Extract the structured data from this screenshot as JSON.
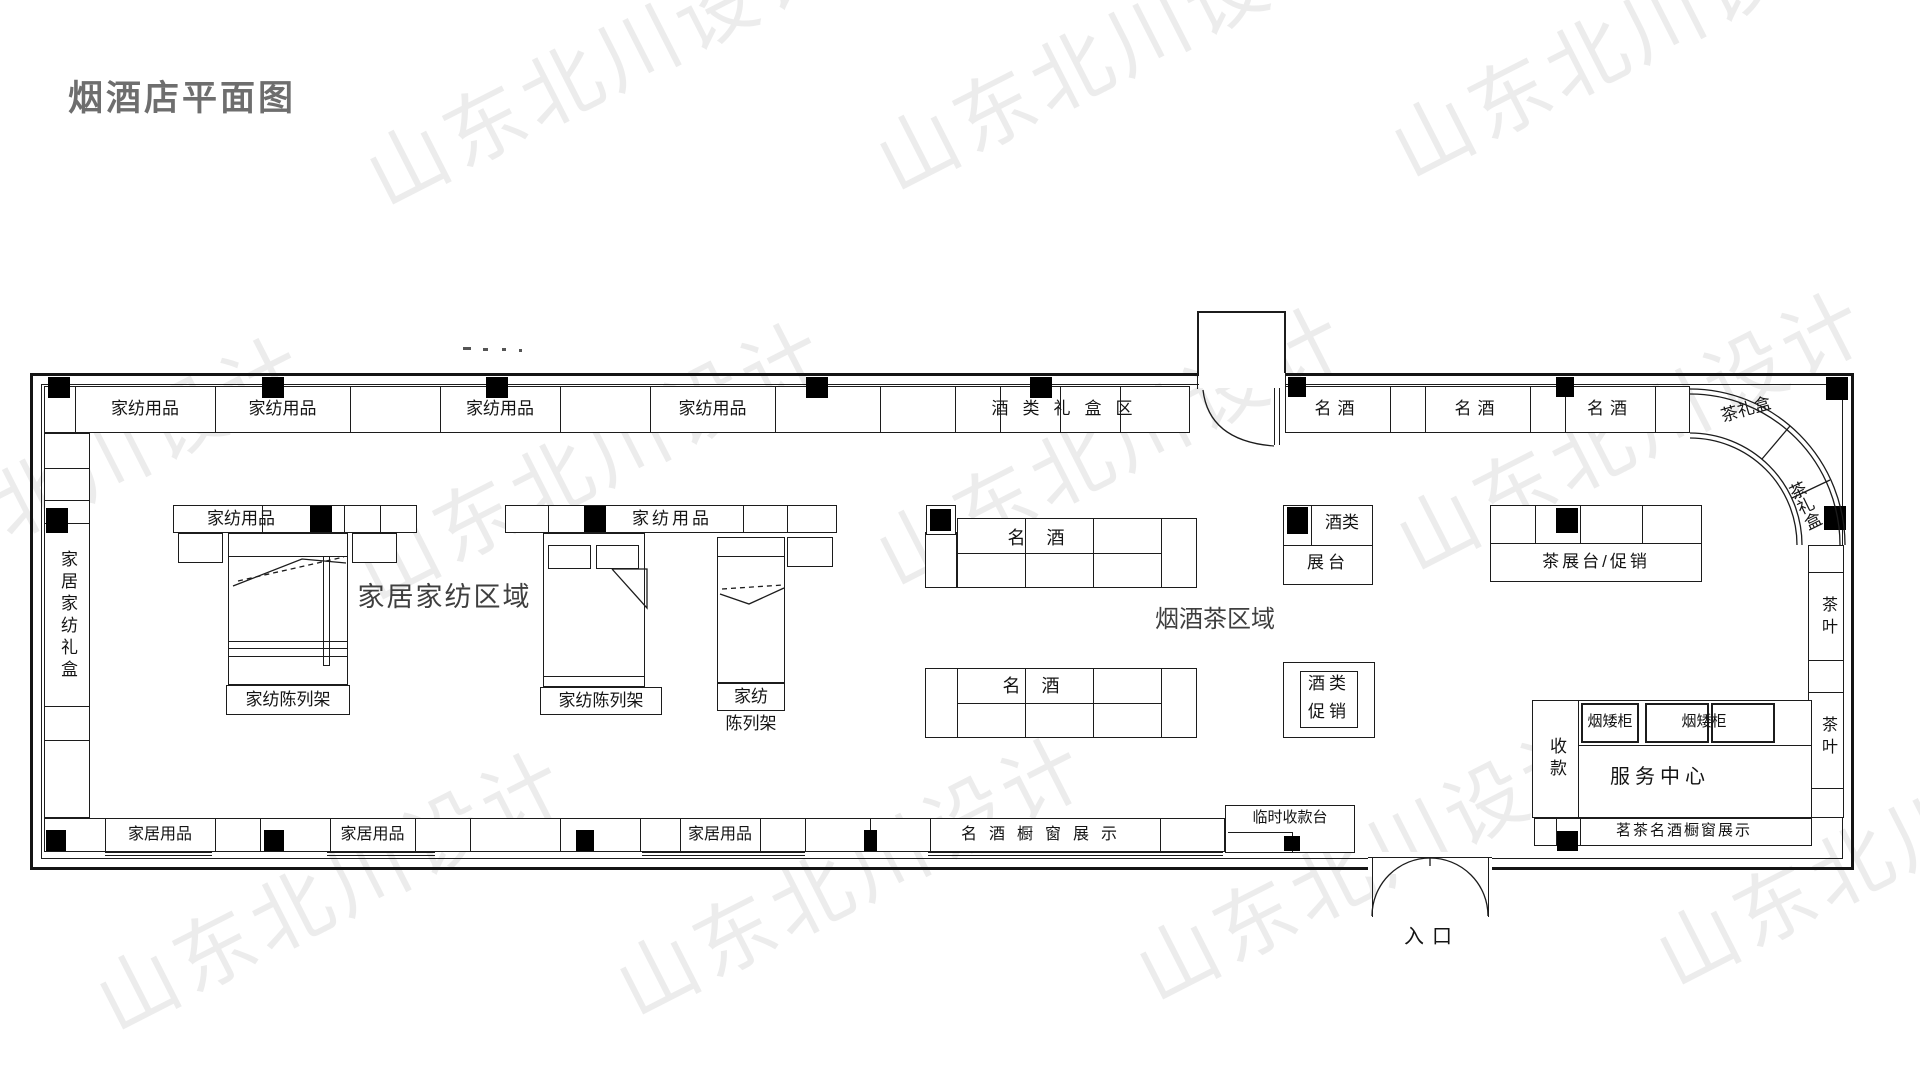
{
  "title": "烟酒店平面图",
  "watermark": {
    "text": "山东北川设计"
  },
  "zones": {
    "home_textile": "家居家纺区域",
    "tobacco_tea": "烟酒茶区域"
  },
  "top_shelves": [
    "家纺用品",
    "家纺用品",
    "家纺用品",
    "家纺用品",
    "酒类礼盒区",
    "名酒",
    "名酒",
    "名酒",
    "茶礼盒"
  ],
  "corner_shelf": "茶礼盒",
  "left_wall_shelf": "家居家纺礼盒",
  "right_wall_shelves": [
    "茶叶",
    "茶叶"
  ],
  "bottom_shelves": [
    "家居用品",
    "家居用品",
    "家居用品",
    "名酒橱窗展示"
  ],
  "fixtures": {
    "textile_strip1": "家纺用品",
    "textile_strip2": "家纺用品",
    "bed1_label": "家纺陈列架",
    "bed2_label": "家纺陈列架",
    "bed3_label_line1": "家纺",
    "bed3_label_line2": "陈列架",
    "wine_table1": "名 酒",
    "wine_table2": "名 酒",
    "wine_stand_line1": "酒类",
    "wine_stand_line2": "展台",
    "tea_stand": "茶展台/促销",
    "wine_promo_line1": "酒类",
    "wine_promo_line2": "促销",
    "cashier": "收款",
    "tobacco_cabinet1": "烟矮柜",
    "tobacco_cabinet2": "烟矮柜",
    "service_center": "服务中心",
    "right_window_display": "茗茶名酒橱窗展示",
    "temp_cashier": "临时收款台"
  },
  "entrance_label": "入口"
}
